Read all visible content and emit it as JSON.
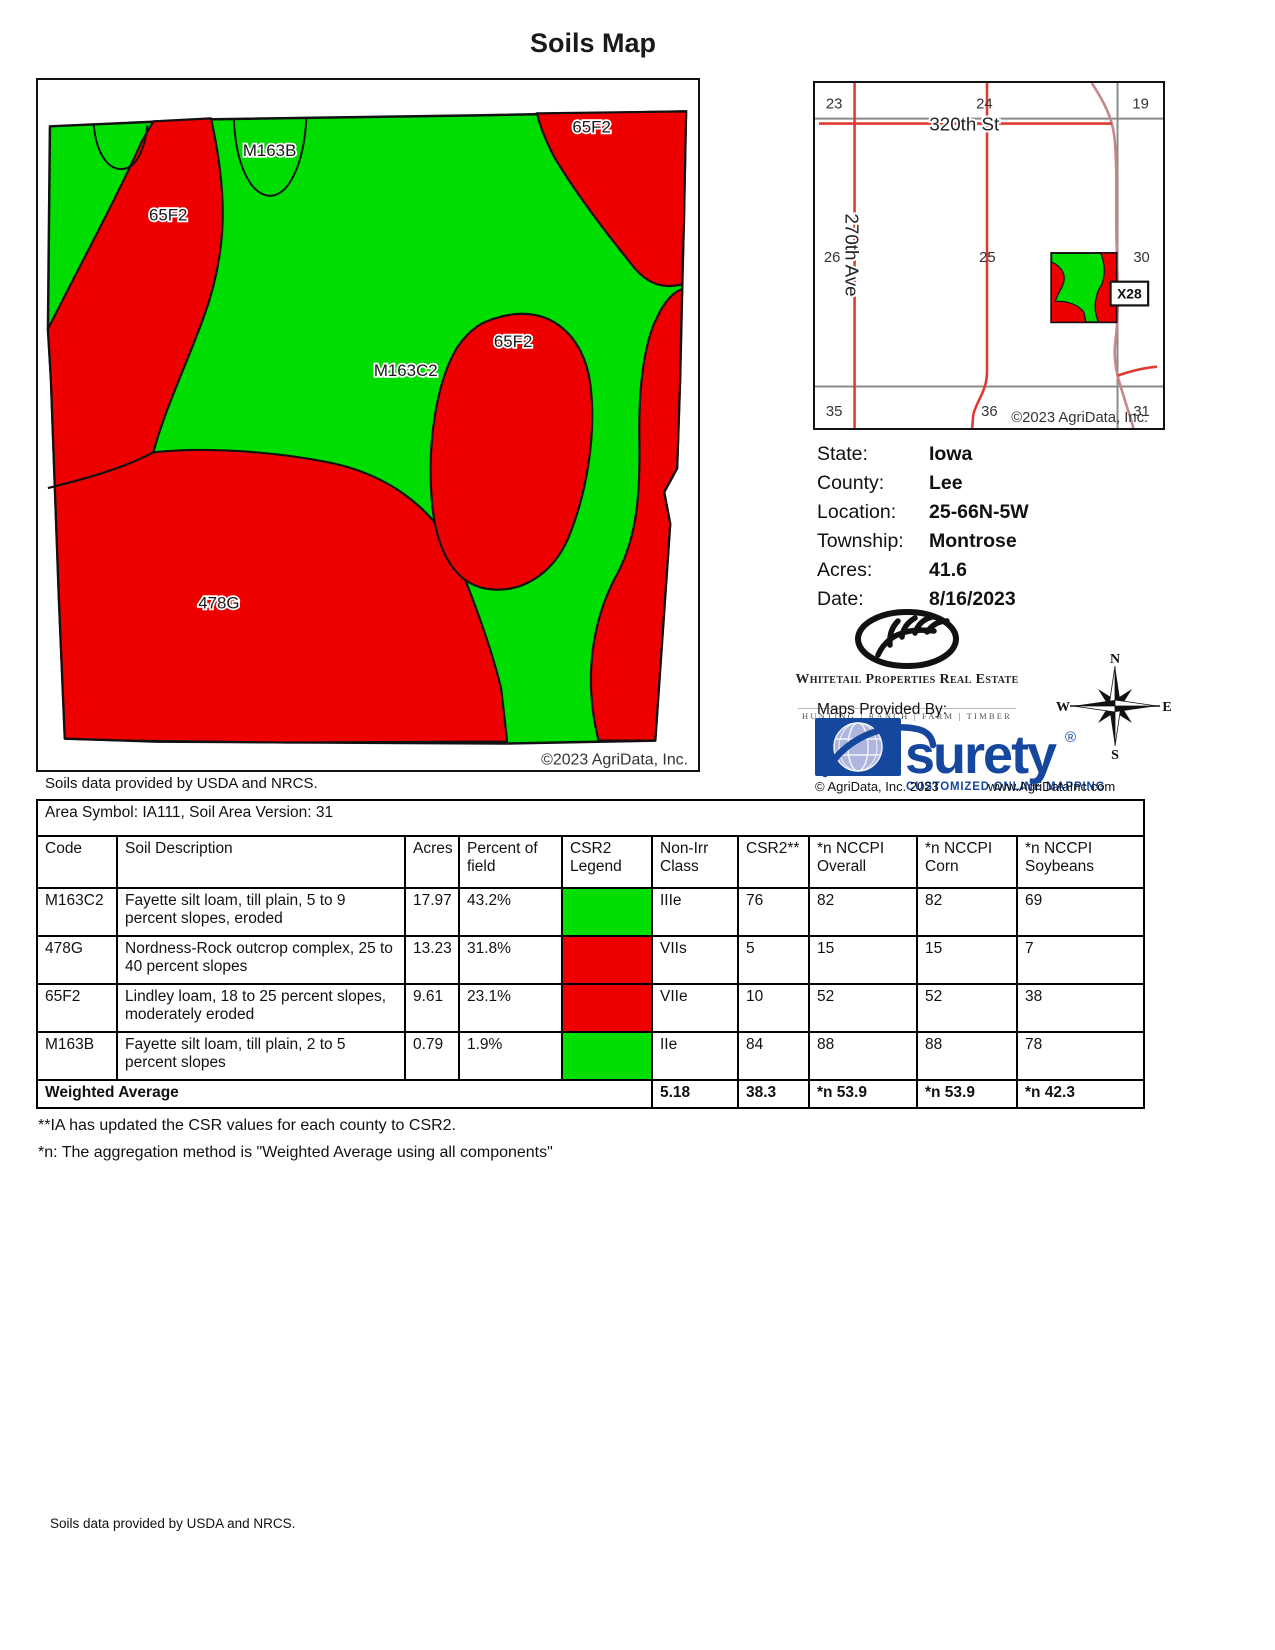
{
  "page": {
    "title": "Soils Map",
    "map_data_note": "Soils data provided by USDA and NRCS.",
    "bottom_note": "Soils data provided by USDA and NRCS.",
    "footnotes": [
      "**IA has updated the CSR values for each county to CSR2.",
      "*n: The aggregation method is \"Weighted Average using all components\""
    ]
  },
  "colors": {
    "soil_green": "#00DD00",
    "soil_red": "#EE0000",
    "road_red": "#E03A30",
    "road_pink": "#C4878C",
    "road_gray": "#8A8A8A",
    "surety_blue": "#16479E"
  },
  "soil_map": {
    "labels": {
      "left_65f2": "65F2",
      "top_right_65f2": "65F2",
      "center_65f2": "65F2",
      "m163b": "M163B",
      "m163c2": "M163C2",
      "g478": "478G"
    },
    "copyright": "©2023 AgriData, Inc."
  },
  "location_map": {
    "sections": [
      "23",
      "24",
      "19",
      "26",
      "25",
      "30",
      "35",
      "36",
      "31"
    ],
    "street_h": "320th St",
    "street_v": "270th Ave",
    "parcel_tag": "X28",
    "copyright": "©2023 AgriData, Inc."
  },
  "property_info": {
    "rows": [
      {
        "label": "State:",
        "value": "Iowa"
      },
      {
        "label": "County:",
        "value": "Lee"
      },
      {
        "label": "Location:",
        "value": "25-66N-5W"
      },
      {
        "label": "Township:",
        "value": "Montrose"
      },
      {
        "label": "Acres:",
        "value": "41.6"
      },
      {
        "label": "Date:",
        "value": "8/16/2023"
      }
    ]
  },
  "branding": {
    "whitetail_name": "Whitetail Properties Real Estate",
    "whitetail_tagline": "HUNTING | RANCH | FARM | TIMBER",
    "maps_provided_by": "Maps Provided By:",
    "surety_name": "surety",
    "surety_reg": "®",
    "surety_tagline": "CUSTOMIZED ONLINE MAPPING",
    "surety_copyright": "© AgriData, Inc. 2023",
    "surety_site": "www.AgriDataInc.com",
    "compass": {
      "n": "N",
      "e": "E",
      "s": "S",
      "w": "W"
    }
  },
  "soil_table": {
    "area_line": "Area Symbol: IA111, Soil Area Version: 31",
    "headers": [
      "Code",
      "Soil Description",
      "Acres",
      "Percent of field",
      "CSR2 Legend",
      "Non-Irr Class",
      "CSR2**",
      "*n NCCPI Overall",
      "*n NCCPI Corn",
      "*n NCCPI Soybeans"
    ],
    "rows": [
      {
        "code": "M163C2",
        "description": "Fayette silt loam, till plain, 5 to 9 percent slopes, eroded",
        "acres": "17.97",
        "percent": "43.2%",
        "legend": "#00DD00",
        "non_irr": "IIIe",
        "csr2": "76",
        "overall": "82",
        "corn": "82",
        "soybeans": "69"
      },
      {
        "code": "478G",
        "description": "Nordness-Rock outcrop complex, 25 to 40 percent slopes",
        "acres": "13.23",
        "percent": "31.8%",
        "legend": "#EE0000",
        "non_irr": "VIIs",
        "csr2": "5",
        "overall": "15",
        "corn": "15",
        "soybeans": "7"
      },
      {
        "code": "65F2",
        "description": "Lindley loam, 18 to 25 percent slopes, moderately eroded",
        "acres": "9.61",
        "percent": "23.1%",
        "legend": "#EE0000",
        "non_irr": "VIIe",
        "csr2": "10",
        "overall": "52",
        "corn": "52",
        "soybeans": "38"
      },
      {
        "code": "M163B",
        "description": "Fayette silt loam, till plain, 2 to 5 percent slopes",
        "acres": "0.79",
        "percent": "1.9%",
        "legend": "#00DD00",
        "non_irr": "IIe",
        "csr2": "84",
        "overall": "88",
        "corn": "88",
        "soybeans": "78"
      }
    ],
    "weighted": {
      "label": "Weighted Average",
      "non_irr": "5.18",
      "csr2": "38.3",
      "overall": "*n 53.9",
      "corn": "*n 53.9",
      "soybeans": "*n 42.3"
    }
  }
}
